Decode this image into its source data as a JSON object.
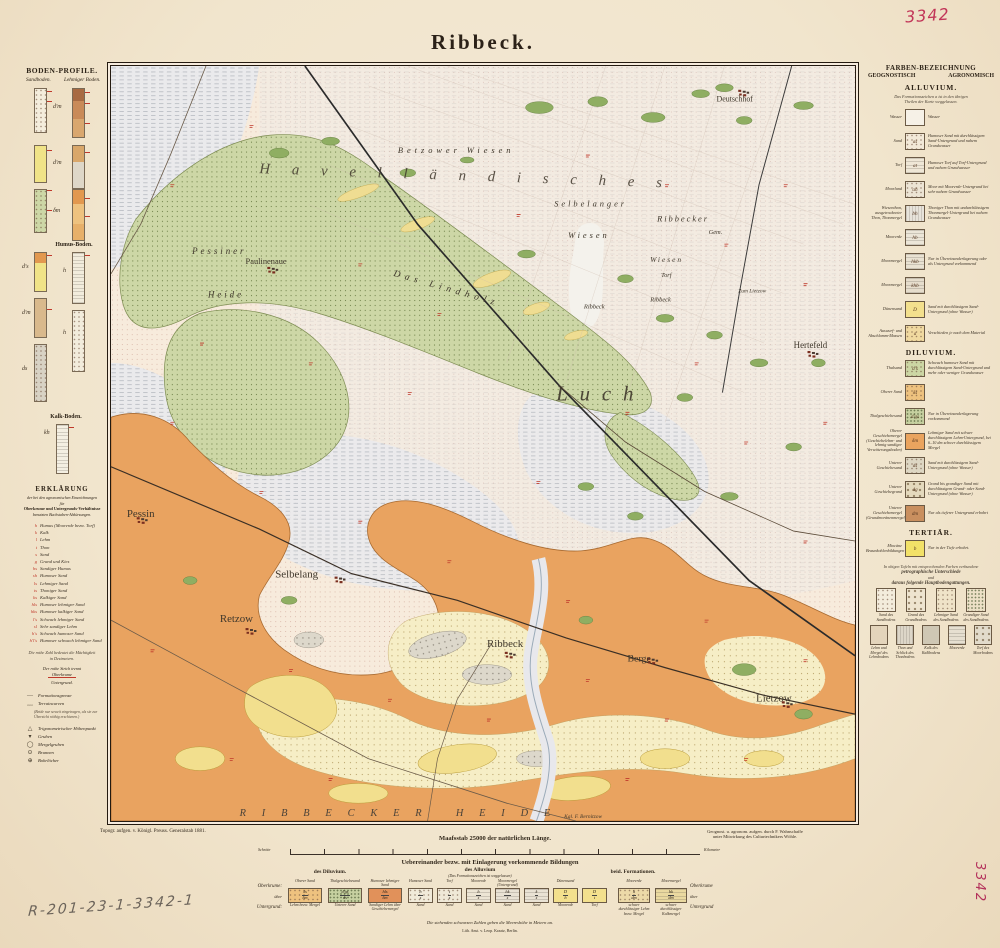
{
  "title": "Ribbeck.",
  "annotations": {
    "top_right": "3342",
    "bottom_right_vertical": "3342",
    "bottom_left_pencil": "R-201-23-1-3342-1"
  },
  "colors": {
    "paper": "#f1e5cd",
    "map_base": "#f6ebdd",
    "marsh": "#e7e8ec",
    "green": "#cdd7a6",
    "dark_green": "#8fae62",
    "orange": "#e9a360",
    "yellow": "#f2df8e",
    "sand": "#f6eec6",
    "till_gray": "#dcd6c8",
    "brown": "#c98f5f",
    "tan": "#eec27f",
    "red_mark": "#c0392b"
  },
  "left_panel": {
    "heading": "BODEN-PROFILE.",
    "col_sand": "Sandboden.",
    "col_lehm": "Lehmiger Boden.",
    "humus_heading": "Humus-Boden.",
    "kalk_heading": "Kalk-Boden.",
    "profile_labels": [
      "d'm",
      "d'm",
      "δm",
      "d's",
      "d'm",
      "ds",
      "h",
      "h",
      "kh"
    ],
    "erklaerung": {
      "heading": "ERKLÄRUNG",
      "sub1": "der bei den agronomischen Einzeichnungen",
      "sub2": "für",
      "sub3": "Oberkrume und Untergrunds-Verhältnisse",
      "sub4": "benutzten Buchstaben-Abkürzungen.",
      "abbrev": [
        [
          "h",
          "Humus (Moorerde bezw. Torf)"
        ],
        [
          "k",
          "Kalk"
        ],
        [
          "l",
          "Lehm"
        ],
        [
          "t",
          "Thon"
        ],
        [
          "s",
          "Sand"
        ],
        [
          "g",
          "Grand und Kies"
        ],
        [
          "hs",
          "Sandiger Humus"
        ],
        [
          "sh",
          "Humoser Sand"
        ],
        [
          "ls",
          "Lehmiger Sand"
        ],
        [
          "ts",
          "Thoniger Sand"
        ],
        [
          "ks",
          "Kalkiger Sand"
        ],
        [
          "hls",
          "Humoser lehmiger Sand"
        ],
        [
          "hks",
          "Humoser kalkiger Sand"
        ],
        [
          "l's",
          "Schwach lehmiger Sand"
        ],
        [
          "sl",
          "Sehr sandiger Lehm"
        ],
        [
          "h's",
          "Schwach humoser Sand"
        ],
        [
          "h'l's",
          "Humoser schwach lehmiger Sand"
        ]
      ],
      "red_note1": "Die rothe Zahl bedeutet die Mächtigkeit",
      "red_note2": "in Dezimetern.",
      "strich1": "Der rothe Strich trennt",
      "strich2": "Oberkrume",
      "strich3": "Untergrund.",
      "symbols_a": [
        {
          "glyph": "—",
          "label": "Formationsgrenze"
        },
        {
          "glyph": "﹏",
          "label": "Terraincurven"
        }
      ],
      "symbols_note": "(Beide nur soweit eingetragen, als sie zur Übersicht nöthig erschienen.)",
      "symbols_b": [
        {
          "glyph": "△",
          "label": "Trigonometrischer Höhenpunkt"
        },
        {
          "glyph": "▾",
          "label": "Gruben"
        },
        {
          "glyph": "◯",
          "label": "Mergelgruben"
        },
        {
          "glyph": "⊙",
          "label": "Brunnen"
        },
        {
          "glyph": "⊕",
          "label": "Bohrlöcher"
        }
      ]
    }
  },
  "right_panel": {
    "heading1": "FARBEN-BEZEICHNUNG",
    "heading2a": "GEOGNOSTISCH",
    "heading2b": "AGRONOMISCH",
    "alluvium_heading": "ALLUVIUM.",
    "alluvium_note1": "Das Formationszeichen a ist in den übrigen",
    "alluvium_note2": "Theilen der Karte weggelassen.",
    "alluvium_rows": [
      {
        "g": "Wasser",
        "sym": "",
        "right": "Wasser",
        "color": "#f6f1e7",
        "cls": "plain"
      },
      {
        "g": "Sand",
        "sym": "as",
        "right": "Humoser Sand mit durchlässigem Sand-Untergrund und nahem Grundwasser",
        "color": "#f2e9d8",
        "cls": "dots"
      },
      {
        "g": "Torf",
        "sym": "at",
        "right": "Humoser Torf auf Torf-Untergrund und nahem Grundwasser",
        "color": "#efe7d6",
        "cls": "dash"
      },
      {
        "g": "Moorland",
        "sym": "ah",
        "right": "Moor mit Moorerde-Untergrund bei sehr nahem Grundwasser",
        "color": "#ece4d4",
        "cls": "dots"
      },
      {
        "g": "Wiesenthon, ausgetrockneter Thon, Thonmergel",
        "sym": "bh",
        "right": "Thoniger Thon mit undurchlässigem Thonmergel-Untergrund bei nahem Grundwasser",
        "color": "#e7e3da",
        "cls": "vdash"
      },
      {
        "g": "Moorerde",
        "sym": "hb",
        "right": "",
        "color": "#ece6d8",
        "cls": "dash"
      },
      {
        "g": "Moormergel",
        "sym": "hkb",
        "right": "Nur in Übereinanderlagerung oder als Untergrund vorkommend",
        "color": "#e9e2d2",
        "cls": "dash"
      },
      {
        "g": "Moormergel",
        "sym": "khb",
        "right": "",
        "color": "#e6ddcc",
        "cls": "dash"
      },
      {
        "g": "Dünensand",
        "sym": "D",
        "right": "Sand mit durchlässigem Sand-Untergrund (ohne Wasser)",
        "color": "#f3e08d",
        "cls": "plain"
      },
      {
        "g": "Auswurf- und Abschlamm-Massen",
        "sym": "a",
        "right": "Verschieden je nach dem Material",
        "color": "#f0d9a0",
        "cls": "dots"
      }
    ],
    "diluvium_heading": "DILUVIUM.",
    "diluvium_rows": [
      {
        "g": "Thalsand",
        "sym": "d's",
        "right": "Schwach humoser Sand mit durchlässigem Sand-Untergrund und mehr oder weniger Grundwasser",
        "color": "#ccd6a4",
        "cls": "dots"
      },
      {
        "g": "Oberer Sand",
        "sym": "δs",
        "right": "",
        "color": "#eec27f",
        "cls": "dots"
      },
      {
        "g": "Thalgeschiebesand",
        "sym": "d'gs",
        "right": "Nur in Übereinanderlagerung vorkommend",
        "color": "#c6d0a0",
        "cls": "dense"
      },
      {
        "g": "Oberer Geschiebemergel (Geschiebelehm- und lehmig sandiger Verwitterungsboden)",
        "sym": "δm",
        "right": "Lehmiger Sand mit schwer durchlässigem Lehm-Untergrund, bei 6–10 dm schwer durchlässigem Mergel",
        "color": "#eaa45f",
        "cls": "plain"
      },
      {
        "g": "Unterer Geschiebesand",
        "sym": "ds",
        "right": "Sand mit durchlässigem Sand-Untergrund (ohne Wasser)",
        "color": "#ded7c3",
        "cls": "dots"
      },
      {
        "g": "Unterer Geschiebegrand",
        "sym": "dg",
        "right": "Grand bis grandiger Sand mit durchlässigem Grand- oder Sand-Untergrund (ohne Wasser)",
        "color": "#e4d9bd",
        "cls": "grand"
      },
      {
        "g": "Unterer Geschiebemergel (Grundmoränenmergel)",
        "sym": "dm",
        "right": "Nur als tieferer Untergrund erbohrt",
        "color": "#c98f5f",
        "cls": "plain"
      }
    ],
    "tertiaer_heading": "TERTIÄR.",
    "tertiaer_rows": [
      {
        "g": "Miocäne Braunkohlenbildungen",
        "sym": "b",
        "right": "Nur in der Tiefe erbohrt.",
        "color": "#f2e168",
        "cls": "plain"
      }
    ],
    "petro_note1": "In obigen Tafeln mit entsprechenden Farben verbundene",
    "petro_note2": "petrographische Unterschiede",
    "petro_note3": "und",
    "petro_note4": "daraus folgende Hauptbodengattungen.",
    "petro_row1": [
      {
        "label": "Sand des Sandbodens",
        "color": "#f3ecdc",
        "cls": "dots"
      },
      {
        "label": "Grand des Grandbodens",
        "color": "#eee4cf",
        "cls": "grand"
      },
      {
        "label": "Lehmiger Sand des Sandbodens",
        "color": "#efe3c8",
        "cls": "dots"
      },
      {
        "label": "Grandiger Sand des Sandbodens",
        "color": "#ece0c6",
        "cls": "dense"
      }
    ],
    "petro_row2": [
      {
        "label": "Lehm und Mergel des Lehmbodens",
        "color": "#e3d4bb",
        "cls": "plain"
      },
      {
        "label": "Thon und Schlick des Thonbodens",
        "color": "#ddd6c8",
        "cls": "vdash"
      },
      {
        "label": "Kalk des Kalkbodens",
        "color": "#cfc7b4",
        "cls": "plain"
      },
      {
        "label": "Moorerde",
        "color": "#e6dfd0",
        "cls": "dash"
      },
      {
        "label": "Torf des Moorbodens",
        "color": "#e2dbcb",
        "cls": "grand"
      }
    ]
  },
  "map": {
    "labels": [
      "Havelländisches",
      "Luch",
      "Betzower Wiesen",
      "Selbelanger",
      "Wiesen",
      "Ribbecker",
      "Gem.",
      "Wiesen",
      "Torf",
      "Ribbeck",
      "Ribbeck",
      "Zum Lietzow",
      "Hertefeld",
      "Deutschhof",
      "Pessiner",
      "Heide",
      "Paulinenaue",
      "Das Lindholz",
      "Pessin",
      "Selbelang",
      "Retzow",
      "Ribbeck",
      "Berge",
      "Lietzow",
      "RIBBECKER HEIDE",
      "Kgl. F. Bernitzow"
    ]
  },
  "footer": {
    "topo_credit": "Topogr. aufgen. v. Königl. Preuss. Generalstab 1881.",
    "geo_credit1": "Geognost. u. agronom. aufgen. durch F. Wahnschaffe",
    "geo_credit2": "unter Mitwirkung des Culturtechnikers Wöhle.",
    "scale_title": "Maafsstab 25000 der natürlichen Länge.",
    "scale_left": "Schritte",
    "scale_right": "Kilometer",
    "strata_title": "Uebereinander bezw. mit Einlagerung vorkommende Bildungen",
    "col_diluvium": "des Diluvium.",
    "col_alluvium": "des Alluvium",
    "col_alluvium_note": "(Das Formationszeichen ist weggelassen)",
    "col_beid": "beid. Formationen.",
    "oberkrume_l": "Oberkrume:",
    "ueber_l": "über",
    "untergrund_l": "Untergrund:",
    "oberkrume_r": "Oberkrume",
    "ueber_r": "über",
    "untergrund_r": "Untergrund",
    "diluvium_cols": [
      {
        "top": "Oberer Sand",
        "sym": "δs",
        "sym2": "δm",
        "bottom": "Lehm bezw. Mergel",
        "color": "#eec27f",
        "cls": "dots"
      },
      {
        "top": "Thalgeschiebesand",
        "sym": "d'gs",
        "sym2": "ds",
        "bottom": "Unterer Sand",
        "color": "#c6d0a0",
        "cls": "dense"
      },
      {
        "top": "Humoser lehmiger Sand",
        "sym": "hls",
        "sym2": "δm",
        "bottom": "Sandiger Lehm über Geschiebemergel",
        "color": "#e1915a",
        "cls": "plain"
      }
    ],
    "alluvium_cols": [
      {
        "top": "Humoser Sand",
        "sym": "h",
        "sym2": "s",
        "bottom": "Sand",
        "color": "#f1ead9",
        "cls": "dots"
      },
      {
        "top": "Torf",
        "sym": "t",
        "sym2": "s",
        "bottom": "Sand",
        "color": "#efe8d7",
        "cls": "dots"
      },
      {
        "top": "Moorerde",
        "sym": "h",
        "sym2": "s",
        "bottom": "Sand",
        "color": "#ede5d4",
        "cls": "dash"
      },
      {
        "top": "Moormergel (Untergrund)",
        "sym": "hk",
        "sym2": "s",
        "bottom": "Sand",
        "color": "#e9e2d4",
        "cls": "dash"
      },
      {
        "top": "",
        "sym": "k",
        "sym2": "s",
        "bottom": "Sand",
        "color": "#e9e2d4",
        "cls": "dash"
      },
      {
        "top": "Dünensand",
        "sym": "D",
        "sym2": "h",
        "bottom": "Moorerde",
        "color": "#f3e08d",
        "cls": "plain"
      },
      {
        "top": "",
        "sym": "D",
        "sym2": "t",
        "bottom": "Torf",
        "color": "#f3e08d",
        "cls": "plain"
      }
    ],
    "beid_cols": [
      {
        "top": "Moorerde",
        "sym": "h",
        "sym2": "dm",
        "bottom": "schwer durchlässiger Lehm bezw. Mergel",
        "color": "#ecd9a8",
        "cls": "dots"
      },
      {
        "top": "Moormergel",
        "sym": "hk",
        "sym2": "dm",
        "bottom": "schwer durchlässiger Kalkmergel",
        "color": "#ead9a0",
        "cls": "dash"
      }
    ],
    "height_note": "Die stehenden schwarzen Zahlen geben die Meereshöhe in Metern an.",
    "lith_credit": "Lith. Anst. v. Leop. Kraatz, Berlin."
  }
}
